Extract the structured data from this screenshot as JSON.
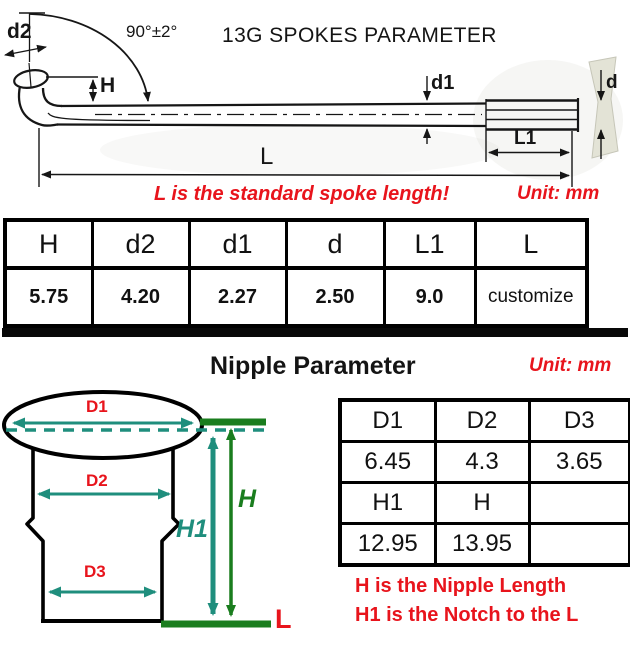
{
  "spoke": {
    "title": "13G SPOKES PARAMETER",
    "angle": "90°±2°",
    "dim_labels": {
      "d2": "d2",
      "h": "H",
      "d1": "d1",
      "d": "d",
      "l1": "L1",
      "l": "L"
    },
    "note": "L is the standard spoke length!",
    "unit": "Unit: mm",
    "table": {
      "headers": [
        "H",
        "d2",
        "d1",
        "d",
        "L1",
        "L"
      ],
      "values": [
        "5.75",
        "4.20",
        "2.27",
        "2.50",
        "9.0",
        "customize"
      ]
    }
  },
  "nipple": {
    "title": "Nipple Parameter",
    "unit": "Unit: mm",
    "dim_labels": {
      "d1": "D1",
      "d2": "D2",
      "d3": "D3",
      "h1": "H1",
      "h": "H",
      "l": "L"
    },
    "table": {
      "rows": [
        [
          "D1",
          "D2",
          "D3"
        ],
        [
          "6.45",
          "4.3",
          "3.65"
        ],
        [
          "H1",
          "H",
          ""
        ],
        [
          "12.95",
          "13.95",
          ""
        ]
      ]
    },
    "notes": [
      "H is the Nipple Length",
      "H1 is the Notch to the L"
    ]
  },
  "colors": {
    "red": "#e8141c",
    "teal": "#1f8e7d",
    "green": "#1a7d1e",
    "ink": "#161616"
  }
}
